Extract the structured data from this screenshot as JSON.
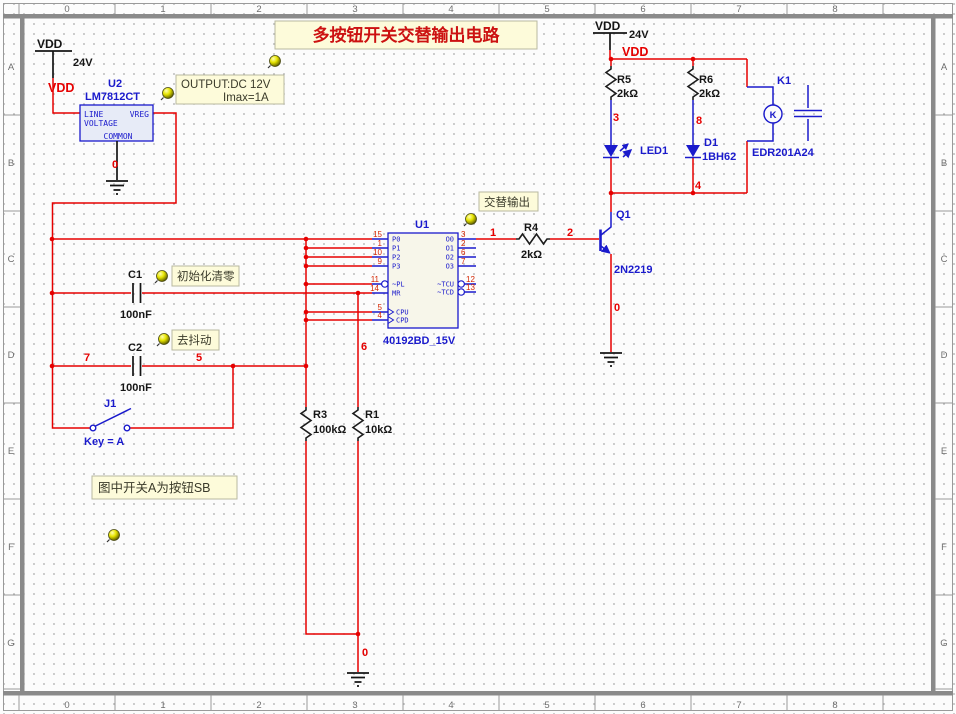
{
  "ruler": {
    "cols": [
      "0",
      "1",
      "2",
      "3",
      "4",
      "5",
      "6",
      "7",
      "8"
    ],
    "rows": [
      "A",
      "B",
      "C",
      "D",
      "E",
      "F",
      "G"
    ]
  },
  "title": "多按钮开关交替输出电路",
  "notes": {
    "output1": "OUTPUT:DC 12V",
    "output2": "Imax=1A",
    "alt": "交替输出",
    "init": "初始化清零",
    "debounce": "去抖动",
    "switch_note": "图中开关A为按钮SB"
  },
  "power": {
    "vdd": "VDD",
    "v24": "24V"
  },
  "nets": {
    "n0": "0",
    "n1": "1",
    "n2": "2",
    "n3": "3",
    "n4": "4",
    "n5": "5",
    "n6": "6",
    "n7": "7",
    "n8": "8"
  },
  "components": {
    "u2": {
      "ref": "U2",
      "part": "LM7812CT",
      "pin_line": "LINE",
      "pin_voltage": "VOLTAGE",
      "pin_vreg": "VREG",
      "pin_common": "COMMON"
    },
    "u1": {
      "ref": "U1",
      "part": "40192BD_15V",
      "left_pins": [
        {
          "num": "15",
          "name": "P0"
        },
        {
          "num": "1",
          "name": "P1"
        },
        {
          "num": "10",
          "name": "P2"
        },
        {
          "num": "9",
          "name": "P3"
        },
        {
          "num": "11",
          "name": "~PL"
        },
        {
          "num": "14",
          "name": "MR"
        },
        {
          "num": "5",
          "name": "CPU"
        },
        {
          "num": "4",
          "name": "CPD"
        }
      ],
      "right_pins": [
        {
          "num": "3",
          "name": "O0"
        },
        {
          "num": "2",
          "name": "O1"
        },
        {
          "num": "6",
          "name": "O2"
        },
        {
          "num": "7",
          "name": "O3"
        },
        {
          "num": "12",
          "name": "~TCU"
        },
        {
          "num": "13",
          "name": "~TCD"
        }
      ]
    },
    "r1": {
      "ref": "R1",
      "value": "10kΩ"
    },
    "r3": {
      "ref": "R3",
      "value": "100kΩ"
    },
    "r4": {
      "ref": "R4",
      "value": "2kΩ"
    },
    "r5": {
      "ref": "R5",
      "value": "2kΩ"
    },
    "r6": {
      "ref": "R6",
      "value": "2kΩ"
    },
    "c1": {
      "ref": "C1",
      "value": "100nF"
    },
    "c2": {
      "ref": "C2",
      "value": "100nF"
    },
    "led1": {
      "ref": "LED1"
    },
    "d1": {
      "ref": "D1",
      "part": "1BH62"
    },
    "q1": {
      "ref": "Q1",
      "part": "2N2219"
    },
    "k1": {
      "ref": "K1",
      "part": "EDR201A24",
      "coil_letter": "K"
    },
    "j1": {
      "ref": "J1",
      "key_label": "Key = A"
    }
  },
  "colors": {
    "wire_red": "#e60000",
    "symbol_blue": "#1a1acc",
    "net_label_red": "#e60000",
    "note_bg": "#fdfbda"
  }
}
